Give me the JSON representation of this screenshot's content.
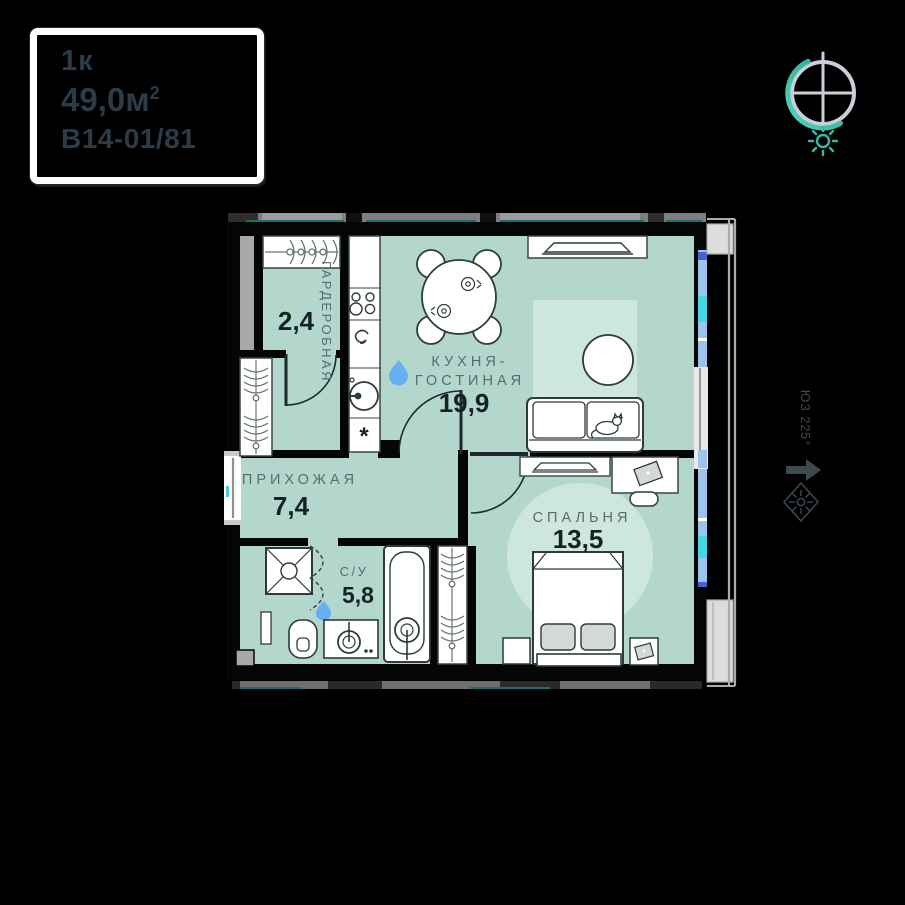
{
  "title_card": {
    "rooms_type": "1к",
    "area_main": "49,0м",
    "area_sup": "2",
    "unit_code": "В14-01/81"
  },
  "plan": {
    "rooms": [
      {
        "id": "wardrobe",
        "name": "ГАРДЕРОБНАЯ",
        "area": "2,4"
      },
      {
        "id": "kitchen-living",
        "name_line1": "КУХНЯ-",
        "name_line2": "ГОСТИНАЯ",
        "area": "19,9"
      },
      {
        "id": "hallway",
        "name": "ПРИХОЖАЯ",
        "area": "7,4"
      },
      {
        "id": "bathroom",
        "name": "С/У",
        "area": "5,8"
      },
      {
        "id": "bedroom",
        "name": "СПАЛЬНЯ",
        "area": "13,5"
      }
    ],
    "washing_machine_marker": "*"
  },
  "compass": {
    "azimuth": "ЮЗ 225°"
  },
  "colors": {
    "room_fill": "#b3d7cd",
    "rug_fill": "#cde7df",
    "wall": "#050505",
    "accent_teal": "#35b9a0",
    "window_blue": "#9dc2ee",
    "water_drop": "#66b0f2",
    "label_gray": "#5a6b6d",
    "number_dark": "#152223"
  }
}
